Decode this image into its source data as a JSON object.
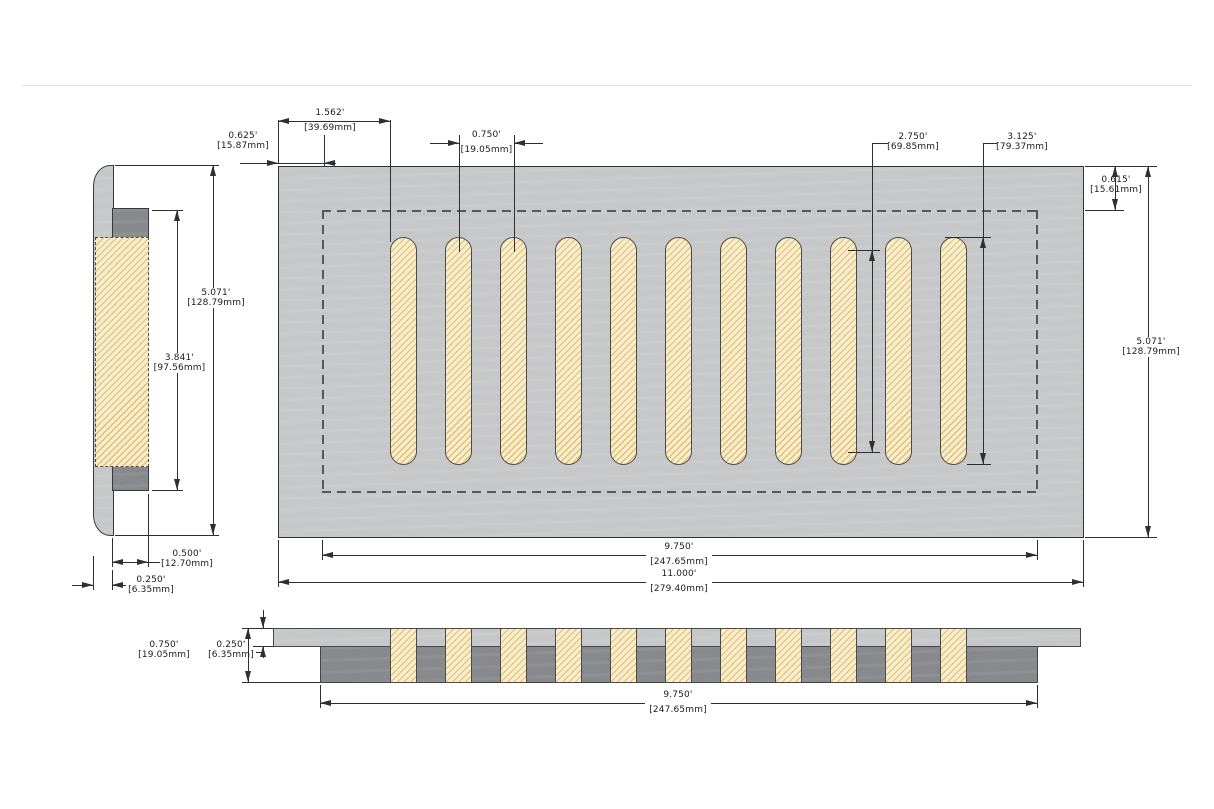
{
  "drawing": {
    "slot_count": 11,
    "colors": {
      "flange_gray": "#c6c7c9",
      "body_gray": "#87898c",
      "slot_fill": "#f9eeca",
      "slot_hatch": "#e3bd7d",
      "line": "#2f2f31",
      "hidden_line": "#56585a",
      "background": "#ffffff"
    },
    "dims": {
      "slot_left_offset": {
        "in": "1.562'",
        "mm": "[39.69mm]"
      },
      "body_left_offset": {
        "in": "0.625'",
        "mm": "[15.87mm]"
      },
      "slot_pitch": {
        "in": "0.750'",
        "mm": "[19.05mm]"
      },
      "slot_straight_length": {
        "in": "2.750'",
        "mm": "[69.85mm]"
      },
      "slot_length": {
        "in": "3.125'",
        "mm": "[79.37mm]"
      },
      "body_top_offset": {
        "in": "0.615'",
        "mm": "[15.61mm]"
      },
      "front_height": {
        "in": "5.071'",
        "mm": "[128.79mm]"
      },
      "front_body_width": {
        "in": "9.750'",
        "mm": "[247.65mm]"
      },
      "overall_width": {
        "in": "11.000'",
        "mm": "[279.40mm]"
      },
      "side_height": {
        "in": "5.071'",
        "mm": "[128.79mm]"
      },
      "side_body_height": {
        "in": "3.841'",
        "mm": "[97.56mm]"
      },
      "side_body_depth": {
        "in": "0.500'",
        "mm": "[12.70mm]"
      },
      "side_flange_thickness": {
        "in": "0.250'",
        "mm": "[6.35mm]"
      },
      "section_total_thickness": {
        "in": "0.750'",
        "mm": "[19.05mm]"
      },
      "section_flange_thickness": {
        "in": "0.250'",
        "mm": "[6.35mm]"
      },
      "section_body_width": {
        "in": "9.750'",
        "mm": "[247.65mm]"
      }
    }
  }
}
